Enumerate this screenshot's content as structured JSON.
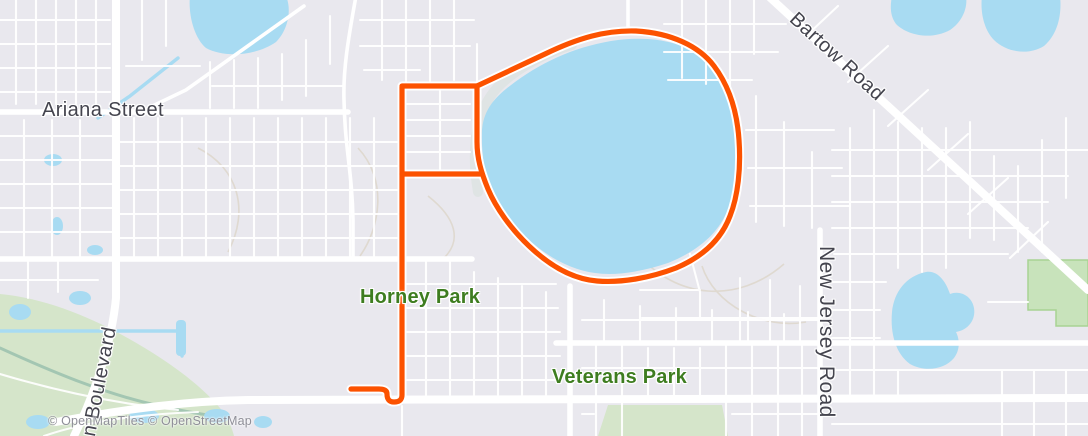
{
  "labels": {
    "ariana_street": "Ariana Street",
    "bartow_road": "Bartow Road",
    "horney_park": "Horney Park",
    "veterans_park": "Veterans Park",
    "boulevard_partial": "n Boulevard",
    "new_jersey_road": "New Jersey Road"
  },
  "attribution": "© OpenMapTiles © OpenStreetMap",
  "colors": {
    "route": "#fc5200",
    "water": "#a8dbf2",
    "background": "#e9e8ee",
    "road": "#ffffff",
    "park-green": "#d5e5ca",
    "park-label": "#3e7d20",
    "street-label": "#44444e",
    "attribution": "#8f8f98"
  },
  "route": {
    "paths": {
      "finish_hook": "M351,389 L379,389 Q387,389 387,394 Q387,402 394,402 Q402,402 402,395 L402,87",
      "rung_top": "M402,86 L477,86",
      "rung_mid": "M402,174 L480,174",
      "lake_loop": "M477,86 L545,54 C578,38 606,30 636,31 C671,33 699,46 714,66 C729,86 737,110 739,140 C741,168 738,196 730,216 C721,240 702,257 676,268 C650,278 621,283 597,281 C572,279 549,265 529,246 C511,229 496,208 488,189 C481,172 477,158 477,142 L477,86"
    }
  }
}
